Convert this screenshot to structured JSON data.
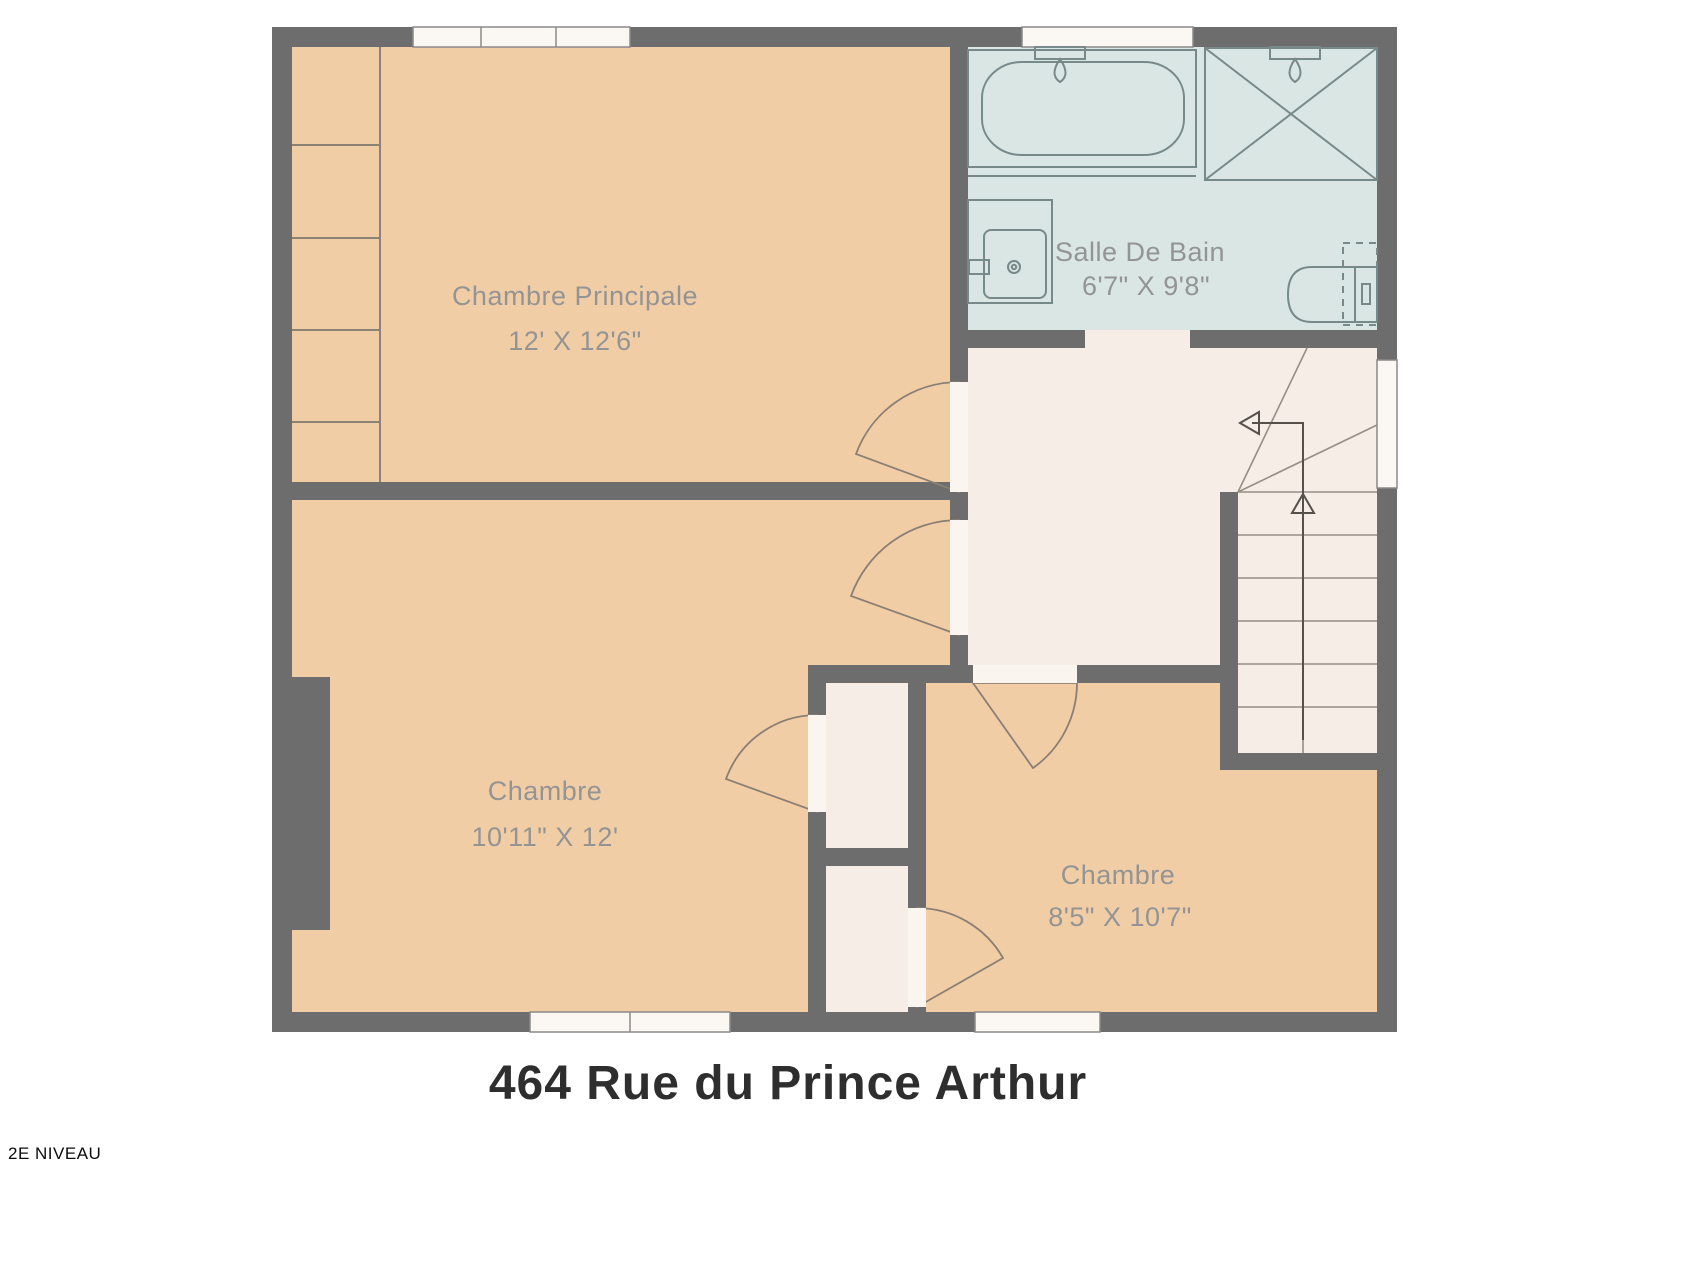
{
  "title": "464 Rue du Prince Arthur",
  "level_label": "2E NIVEAU",
  "rooms": [
    {
      "name": "Chambre Principale",
      "dimensions": "12' X 12'6\""
    },
    {
      "name": "Salle De Bain",
      "dimensions": "6'7\" X 9'8\""
    },
    {
      "name": "Chambre",
      "dimensions": "10'11\" X 12'"
    },
    {
      "name": "Chambre",
      "dimensions": "8'5\" X 10'7\""
    }
  ],
  "fixtures": [
    "bathtub",
    "shower",
    "sink-vanity",
    "toilet",
    "staircase-up",
    "door-swing",
    "window"
  ],
  "colors": {
    "wall": "#6d6d6d",
    "room_peach": "#f1cda6",
    "hall_cream": "#f5ede6",
    "bathroom_blue": "#d9e6e4",
    "window_white": "#fbf7f2",
    "fixture_stroke": "#78898a",
    "label_text": "#949494",
    "title_text": "#2e2e2e"
  }
}
